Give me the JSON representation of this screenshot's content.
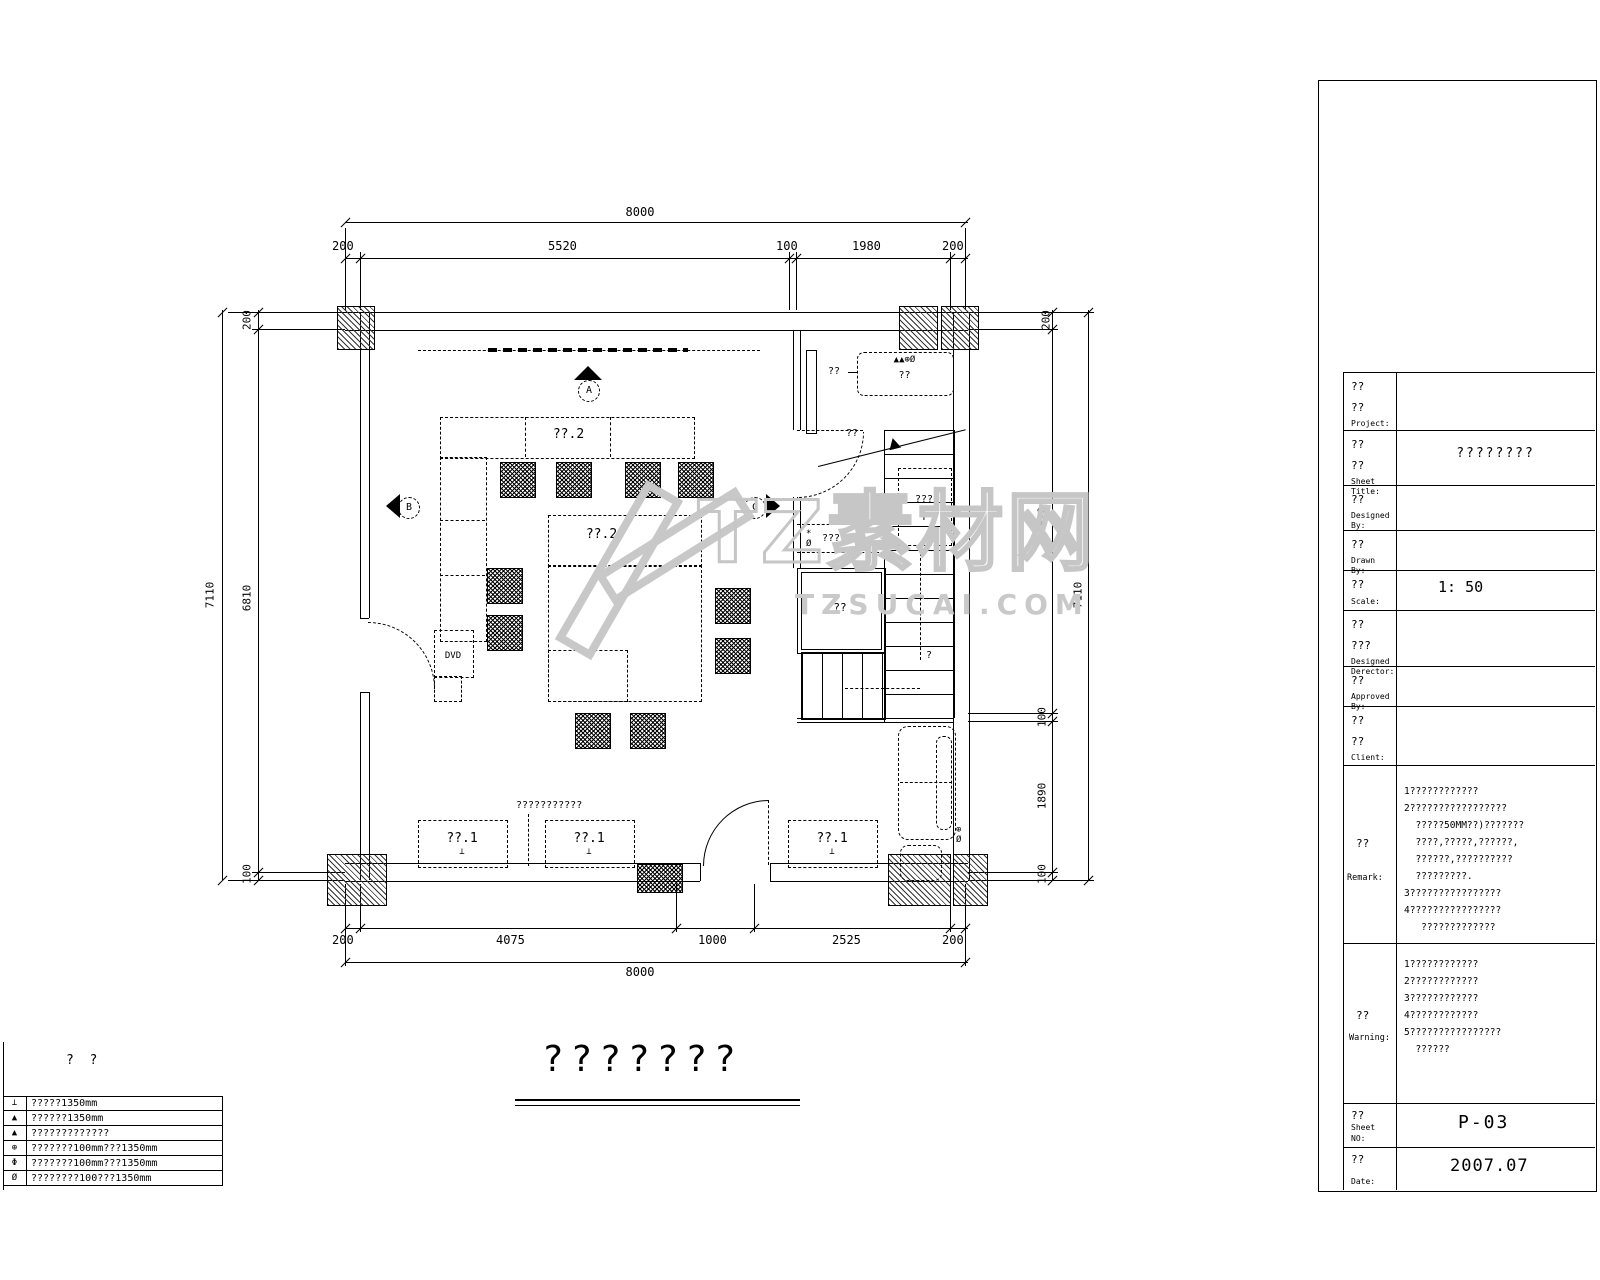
{
  "watermark": {
    "logo_text": "TZ素材网",
    "domain": "TZSUCAI.COM"
  },
  "drawing": {
    "title": "???????",
    "dims": {
      "top": {
        "overall": "8000",
        "segs": [
          "200",
          "5520",
          "100",
          "1980",
          "200"
        ]
      },
      "bottom": {
        "overall": "8000",
        "segs": [
          "200",
          "4075",
          "1000",
          "2525",
          "200"
        ]
      },
      "left": {
        "overall": "7110",
        "segs": [
          "200",
          "6810",
          "100"
        ]
      },
      "right": {
        "overall": "7110",
        "segs": [
          "200",
          "4820",
          "100",
          "1890",
          "100"
        ]
      }
    },
    "labels": {
      "sofa_zone_top": "??.2",
      "sofa_zone_mid": "??.2",
      "cabinet_1": "??.1",
      "cabinet_2": "??.1",
      "cabinet_3": "??.1",
      "floor_sym": "⊥",
      "dvd": "DVD",
      "note": "???????????",
      "hall_top": "??",
      "hall_door": "??",
      "closet_syms": "▲▲⊕Ø",
      "closet": "??",
      "coat_syms": "*Ø",
      "coat": "????",
      "stairs": "???",
      "stairs_arrow": "↑",
      "stair_q": "?",
      "room": "??",
      "sofa_syms": "⊕Ø",
      "marker_a": "A",
      "marker_b": "B",
      "marker_c": "C"
    }
  },
  "legend": {
    "header": "?  ?",
    "rows": [
      {
        "sym": "⊥",
        "text": "?????1350mm"
      },
      {
        "sym": "▲",
        "text": "??????1350mm"
      },
      {
        "sym": "▲",
        "text": "?????????????"
      },
      {
        "sym": "⊕",
        "text": "???????100mm???1350mm"
      },
      {
        "sym": "Φ",
        "text": "???????100mm???1350mm"
      },
      {
        "sym": "Ø",
        "text": "????????100???1350mm"
      }
    ]
  },
  "title_block": {
    "project": {
      "cn1": "??",
      "cn2": "??",
      "en": "Project:",
      "value": ""
    },
    "sheet_title": {
      "cn1": "??",
      "cn2": "??",
      "en": "Sheet Title:",
      "value": "????????"
    },
    "designed_by": {
      "cn1": "??",
      "en": "Designed By:",
      "value": ""
    },
    "drawn_by": {
      "cn1": "??",
      "en": "Drawn By:",
      "value": ""
    },
    "scale": {
      "cn1": "??",
      "en": "Scale:",
      "value": "1: 50"
    },
    "designed_director": {
      "cn1": "??",
      "cn2": "???",
      "en": "Designed Derector:",
      "value": ""
    },
    "approved_by": {
      "cn1": "??",
      "en": "Approved By:",
      "value": ""
    },
    "client": {
      "cn1": "??",
      "cn2": "??",
      "en": "Client:",
      "value": ""
    },
    "remark": {
      "cn1": "??",
      "en": "Remark:",
      "lines": [
        "1????????????",
        "2?????????????????",
        "  ?????50MM??)???????",
        "  ????,?????,??????,",
        "  ??????,??????????",
        "  ?????????.",
        "3????????????????",
        "4????????????????",
        "   ?????????????"
      ]
    },
    "warning": {
      "cn1": "??",
      "en": "Warning:",
      "lines": [
        "1????????????",
        "2????????????",
        "3????????????",
        "4????????????",
        "5????????????????",
        "  ??????"
      ]
    },
    "sheet_no": {
      "cn1": "??",
      "en": "Sheet NO:",
      "value": "P-03"
    },
    "date": {
      "cn1": "??",
      "en": "Date:",
      "value": "2007.07"
    }
  }
}
